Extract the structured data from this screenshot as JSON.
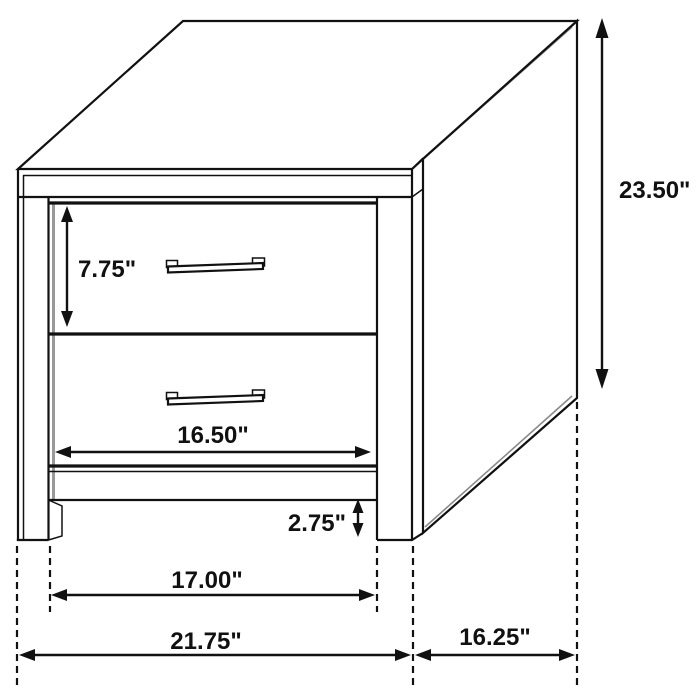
{
  "colors": {
    "line": "#111111",
    "shadow": "#8a8a8a",
    "background": "#ffffff",
    "dimension_text": "#111111"
  },
  "diagram": {
    "labels": {
      "drawer_height": "7.75\"",
      "drawer_width": "16.50\"",
      "base_clearance": "2.75\"",
      "leg_span": "17.00\"",
      "overall_width": "21.75\"",
      "depth": "16.25\"",
      "overall_height": "23.50\""
    }
  }
}
